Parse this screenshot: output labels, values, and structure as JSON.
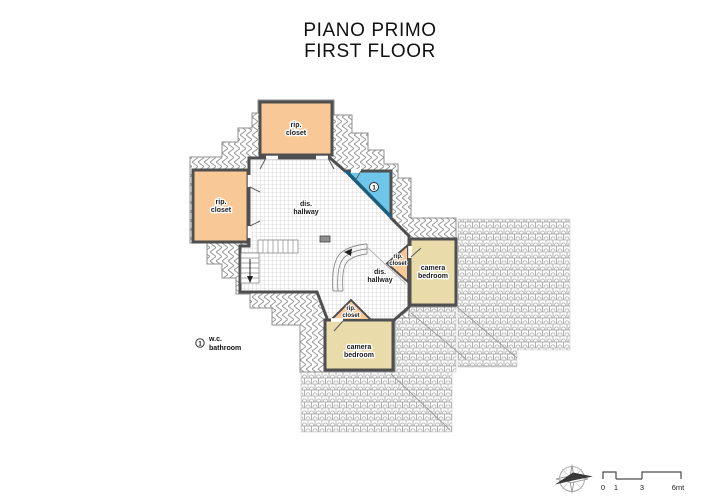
{
  "title": {
    "line1": "PIANO PRIMO",
    "line2": "FIRST FLOOR"
  },
  "rooms": {
    "closet_top": {
      "l1": "rip.",
      "l2": "closet"
    },
    "closet_left": {
      "l1": "rip.",
      "l2": "closet"
    },
    "closet_right": {
      "l1": "rip.",
      "l2": "closet"
    },
    "closet_bottom": {
      "l1": "rip.",
      "l2": "closet"
    },
    "hallway_upper": {
      "l1": "dis.",
      "l2": "hallway"
    },
    "hallway_lower": {
      "l1": "dis.",
      "l2": "hallway"
    },
    "bedroom_right": {
      "l1": "camera",
      "l2": "bedroom"
    },
    "bedroom_bottom": {
      "l1": "camera",
      "l2": "bedroom"
    },
    "bathroom": {
      "symbol": "1"
    }
  },
  "legend": {
    "symbol": "1",
    "line1": "w.c.",
    "line2": "bathroom"
  },
  "scale_bar": {
    "t0": "0",
    "t1": "1",
    "t3": "3",
    "t6": "6mt"
  },
  "colors": {
    "closet": "#f8c897",
    "bedroom": "#e9dcaa",
    "bathroom": "#6ec7ea",
    "wall": "#4f4f4f",
    "hatch_line": "#9a9a9a"
  }
}
